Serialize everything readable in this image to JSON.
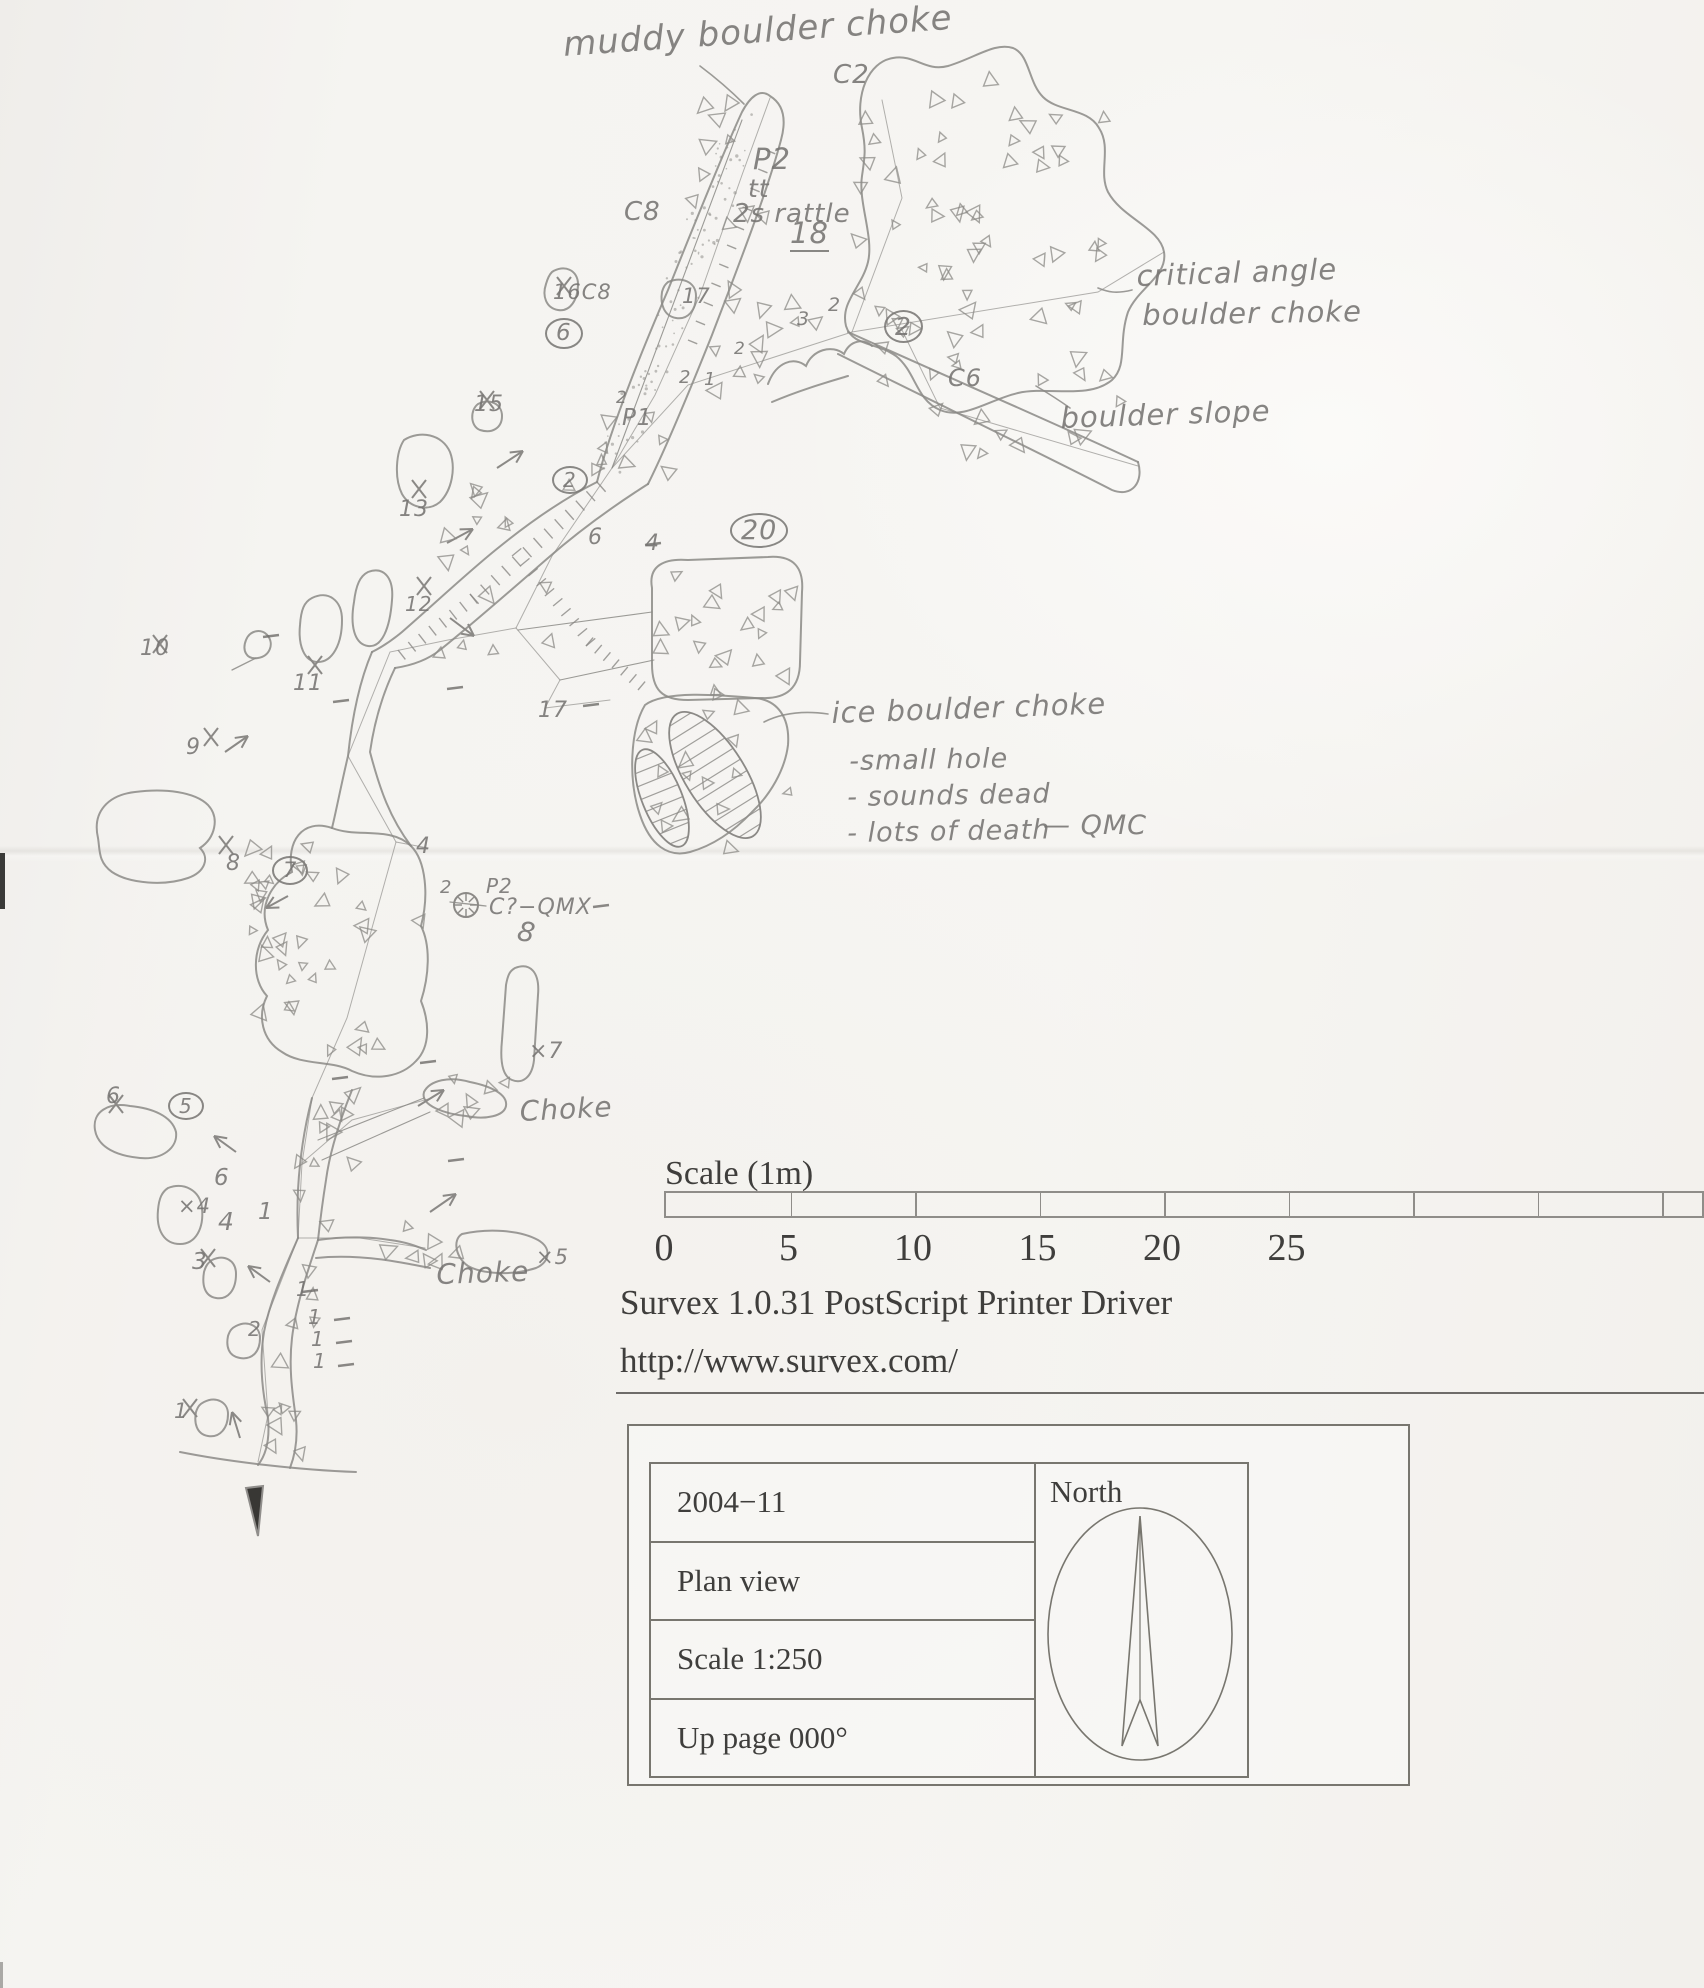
{
  "map": {
    "annotations": [
      {
        "text": "muddy boulder choke",
        "x": 562,
        "y": 28,
        "size": 34,
        "rot": -4
      },
      {
        "text": "C2",
        "x": 833,
        "y": 62,
        "size": 26
      },
      {
        "text": "P2",
        "x": 753,
        "y": 145,
        "size": 29
      },
      {
        "text": "tt",
        "x": 748,
        "y": 176,
        "size": 25
      },
      {
        "text": "2s rattle",
        "x": 733,
        "y": 201,
        "size": 26
      },
      {
        "text": "18",
        "x": 790,
        "y": 219,
        "size": 29,
        "underline": true
      },
      {
        "text": "C8",
        "x": 624,
        "y": 199,
        "size": 26
      },
      {
        "text": "16C8",
        "x": 553,
        "y": 282,
        "size": 21
      },
      {
        "text": "6",
        "x": 545,
        "y": 318,
        "size": 23,
        "circled": true
      },
      {
        "text": "17",
        "x": 682,
        "y": 286,
        "size": 21
      },
      {
        "text": "2",
        "x": 828,
        "y": 296,
        "size": 19
      },
      {
        "text": "3",
        "x": 797,
        "y": 310,
        "size": 19
      },
      {
        "text": "2",
        "x": 734,
        "y": 341,
        "size": 17
      },
      {
        "text": "2",
        "x": 679,
        "y": 369,
        "size": 18
      },
      {
        "text": "1",
        "x": 704,
        "y": 371,
        "size": 18
      },
      {
        "text": "2",
        "x": 884,
        "y": 310,
        "size": 25,
        "circled": true
      },
      {
        "text": "critical angle",
        "x": 1136,
        "y": 262,
        "size": 29,
        "rot": -2
      },
      {
        "text": "boulder choke",
        "x": 1142,
        "y": 301,
        "size": 29,
        "rot": -1
      },
      {
        "text": "C6",
        "x": 948,
        "y": 366,
        "size": 24
      },
      {
        "text": "boulder slope",
        "x": 1060,
        "y": 404,
        "size": 29,
        "rot": -2
      },
      {
        "text": "2",
        "x": 616,
        "y": 390,
        "size": 17
      },
      {
        "text": "P1",
        "x": 622,
        "y": 407,
        "size": 23
      },
      {
        "text": "15",
        "x": 474,
        "y": 394,
        "size": 22
      },
      {
        "text": "2",
        "x": 552,
        "y": 466,
        "size": 20,
        "circled": true
      },
      {
        "text": "13",
        "x": 399,
        "y": 499,
        "size": 22
      },
      {
        "text": "6",
        "x": 588,
        "y": 527,
        "size": 22
      },
      {
        "text": "4",
        "x": 645,
        "y": 533,
        "size": 22
      },
      {
        "text": "20",
        "x": 730,
        "y": 513,
        "size": 27,
        "circled": true
      },
      {
        "text": "12",
        "x": 405,
        "y": 594,
        "size": 20
      },
      {
        "text": "10",
        "x": 140,
        "y": 638,
        "size": 22
      },
      {
        "text": "11",
        "x": 293,
        "y": 673,
        "size": 22
      },
      {
        "text": "17",
        "x": 538,
        "y": 700,
        "size": 22
      },
      {
        "text": "9",
        "x": 186,
        "y": 737,
        "size": 22
      },
      {
        "text": "ice boulder choke",
        "x": 831,
        "y": 699,
        "size": 29,
        "rot": -2
      },
      {
        "text": "-small hole",
        "x": 849,
        "y": 748,
        "size": 27,
        "rot": -1
      },
      {
        "text": "- sounds dead",
        "x": 847,
        "y": 784,
        "size": 27,
        "rot": -1
      },
      {
        "text": "- lots of death",
        "x": 847,
        "y": 820,
        "size": 27,
        "rot": -1
      },
      {
        "text": "— QMC",
        "x": 1043,
        "y": 812,
        "size": 27
      },
      {
        "text": "8",
        "x": 226,
        "y": 853,
        "size": 22
      },
      {
        "text": "7",
        "x": 272,
        "y": 856,
        "size": 21,
        "circled": true
      },
      {
        "text": "4",
        "x": 416,
        "y": 836,
        "size": 22
      },
      {
        "text": "2",
        "x": 440,
        "y": 879,
        "size": 18
      },
      {
        "text": "P2",
        "x": 486,
        "y": 876,
        "size": 20
      },
      {
        "text": "C?−QMX",
        "x": 489,
        "y": 897,
        "size": 22
      },
      {
        "text": "8",
        "x": 520,
        "y": 918,
        "size": 27,
        "rot": 10
      },
      {
        "text": "×7",
        "x": 529,
        "y": 1041,
        "size": 22
      },
      {
        "text": "Choke",
        "x": 519,
        "y": 1098,
        "size": 28,
        "rot": -3
      },
      {
        "text": "6",
        "x": 106,
        "y": 1086,
        "size": 22
      },
      {
        "text": "5",
        "x": 168,
        "y": 1092,
        "size": 20,
        "circled": true
      },
      {
        "text": "6",
        "x": 214,
        "y": 1167,
        "size": 23
      },
      {
        "text": "×4",
        "x": 178,
        "y": 1196,
        "size": 21
      },
      {
        "text": "4",
        "x": 218,
        "y": 1209,
        "size": 25
      },
      {
        "text": "1",
        "x": 258,
        "y": 1201,
        "size": 23
      },
      {
        "text": "3",
        "x": 192,
        "y": 1251,
        "size": 23
      },
      {
        "text": "Choke",
        "x": 436,
        "y": 1261,
        "size": 28,
        "rot": -2
      },
      {
        "text": "×5",
        "x": 536,
        "y": 1247,
        "size": 21
      },
      {
        "text": "1",
        "x": 296,
        "y": 1279,
        "size": 20
      },
      {
        "text": "2",
        "x": 248,
        "y": 1319,
        "size": 20
      },
      {
        "text": "1",
        "x": 308,
        "y": 1307,
        "size": 20
      },
      {
        "text": "1",
        "x": 311,
        "y": 1329,
        "size": 20
      },
      {
        "text": "1",
        "x": 313,
        "y": 1351,
        "size": 20
      },
      {
        "text": "1",
        "x": 174,
        "y": 1401,
        "size": 21
      }
    ]
  },
  "scalebar": {
    "title": "Scale (1m)",
    "labels": [
      "0",
      "5",
      "10",
      "15",
      "20",
      "25"
    ]
  },
  "footer": {
    "line1": "Survex 1.0.31 PostScript Printer Driver",
    "line2": "http://www.survex.com/"
  },
  "infobox": {
    "rows": [
      "2004−11",
      "Plan view",
      "Scale 1:250",
      "Up page 000°"
    ],
    "north_label": "North"
  }
}
